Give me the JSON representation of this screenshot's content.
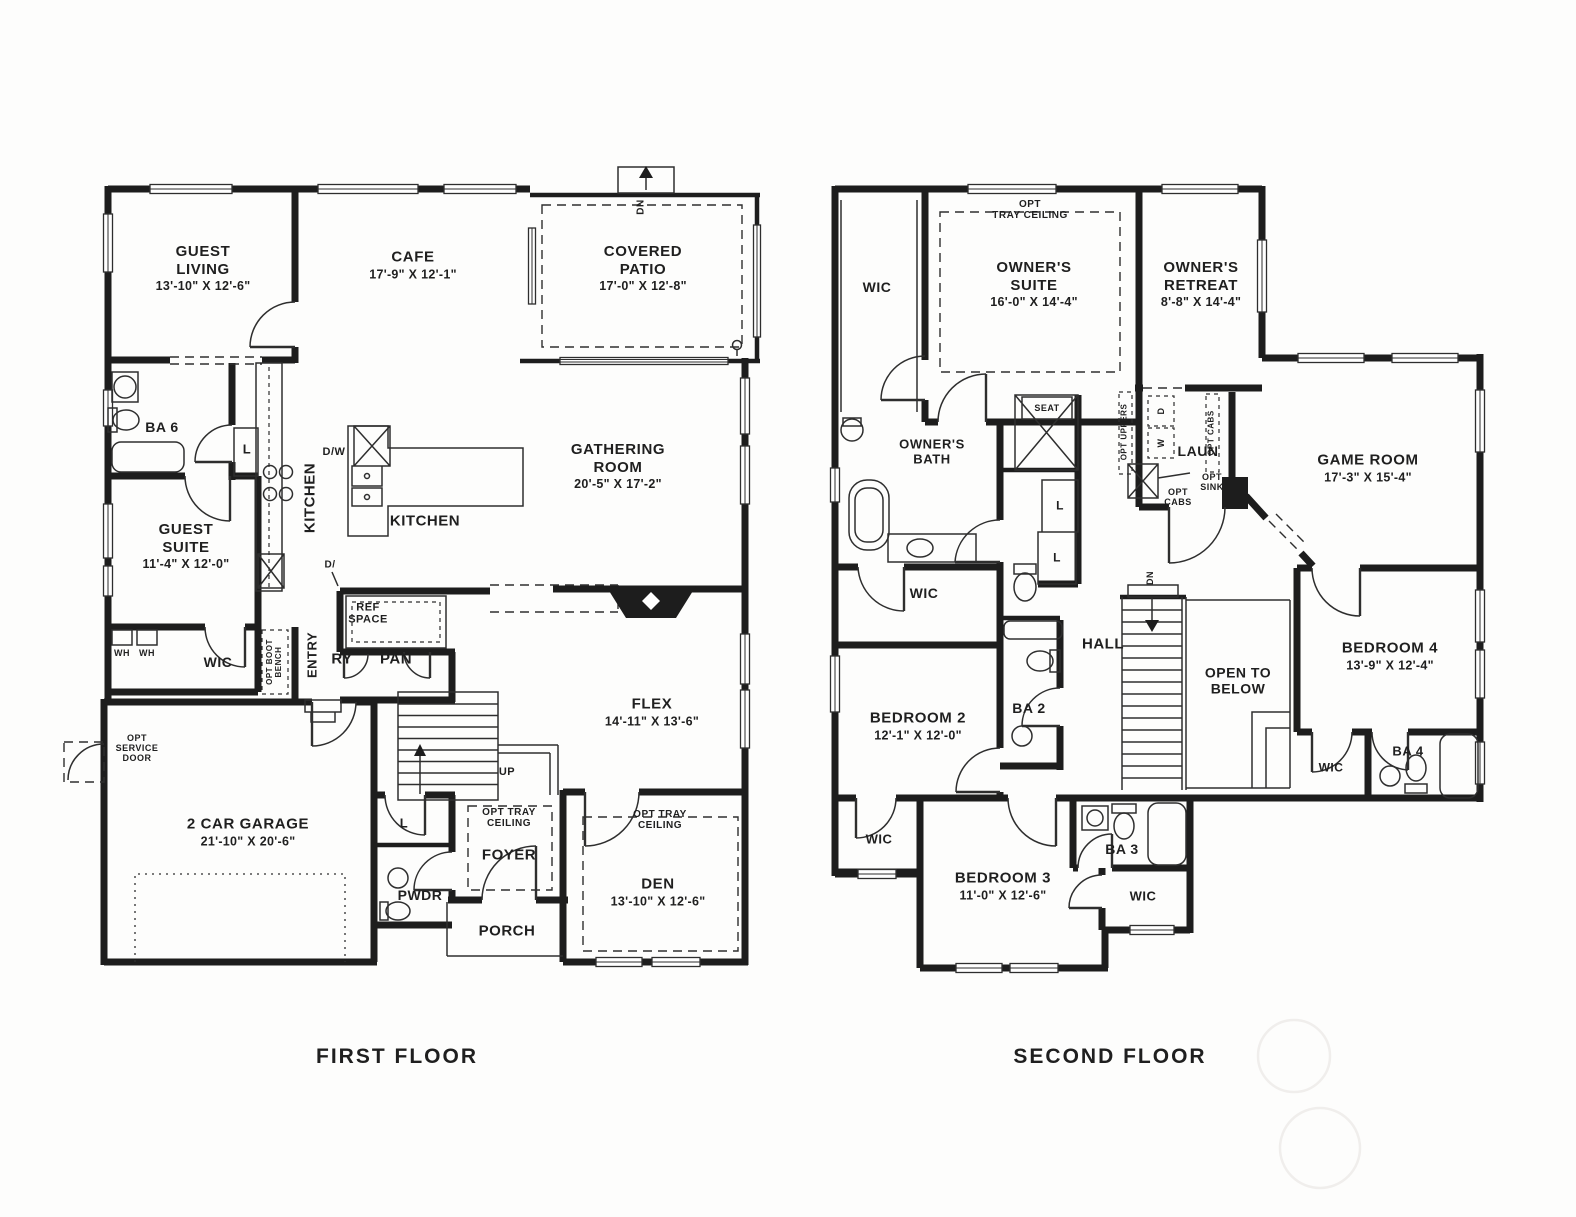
{
  "floor1": {
    "title": "FIRST FLOOR",
    "guest_living": {
      "name": "GUEST\nLIVING",
      "dims": "13'-10\" X 12'-6\""
    },
    "cafe": {
      "name": "CAFE",
      "dims": "17'-9\" X 12'-1\""
    },
    "covered_patio": {
      "name": "COVERED\nPATIO",
      "dims": "17'-0\" X 12'-8\""
    },
    "gathering_room": {
      "name": "GATHERING\nROOM",
      "dims": "20'-5\" X 17'-2\""
    },
    "guest_suite": {
      "name": "GUEST\nSUITE",
      "dims": "11'-4\" X 12'-0\""
    },
    "kitchen": {
      "name": "KITCHEN"
    },
    "flex": {
      "name": "FLEX",
      "dims": "14'-11\" X 13'-6\""
    },
    "garage": {
      "name": "2 CAR GARAGE",
      "dims": "21'-10\" X 20'-6\""
    },
    "den": {
      "name": "DEN",
      "dims": "13'-10\" X 12'-6\""
    },
    "foyer": {
      "name": "FOYER"
    },
    "porch": {
      "name": "PORCH"
    },
    "pwdr": {
      "name": "PWDR"
    },
    "ba6": {
      "name": "BA 6"
    },
    "wic": {
      "name": "WIC"
    },
    "entry": {
      "name": "ENTRY"
    },
    "pantry_a": "RY",
    "pantry_b": "PAN",
    "ref_space": "REF\nSPACE",
    "opt_tray_ceiling": "OPT TRAY\nCEILING",
    "opt_service_door": "OPT\nSERVICE\nDOOR",
    "opt_boot_bench": "OPT BOOT\nBENCH",
    "wh": "WH",
    "closet": "L",
    "dw": "D/W",
    "dw2": "D/",
    "up": "UP",
    "dn": "DN"
  },
  "floor2": {
    "title": "SECOND FLOOR",
    "owners_suite": {
      "name": "OWNER'S\nSUITE",
      "dims": "16'-0\" X 14'-4\""
    },
    "owners_retreat": {
      "name": "OWNER'S\nRETREAT",
      "dims": "8'-8\" X 14'-4\""
    },
    "owners_bath": {
      "name": "OWNER'S\nBATH"
    },
    "game_room": {
      "name": "GAME ROOM",
      "dims": "17'-3\" X 15'-4\""
    },
    "bedroom2": {
      "name": "BEDROOM 2",
      "dims": "12'-1\" X 12'-0\""
    },
    "bedroom3": {
      "name": "BEDROOM 3",
      "dims": "11'-0\" X 12'-6\""
    },
    "bedroom4": {
      "name": "BEDROOM 4",
      "dims": "13'-9\" X 12'-4\""
    },
    "ba2": {
      "name": "BA 2"
    },
    "ba3": {
      "name": "BA 3"
    },
    "ba4": {
      "name": "BA 4"
    },
    "laun": {
      "name": "LAUN"
    },
    "hall": {
      "name": "HALL"
    },
    "open_to_below": "OPEN TO\nBELOW",
    "wic": "WIC",
    "seat": "SEAT",
    "opt_tray_ceiling": "OPT\nTRAY CEILING",
    "opt_uppers": "OPT UPPERS",
    "opt_cabs": "OPT CABS",
    "opt_cabs_2": "OPT\nCABS",
    "opt_sink": "OPT\nSINK",
    "washer": "W",
    "dryer": "D",
    "closet": "L",
    "dn": "DN"
  }
}
